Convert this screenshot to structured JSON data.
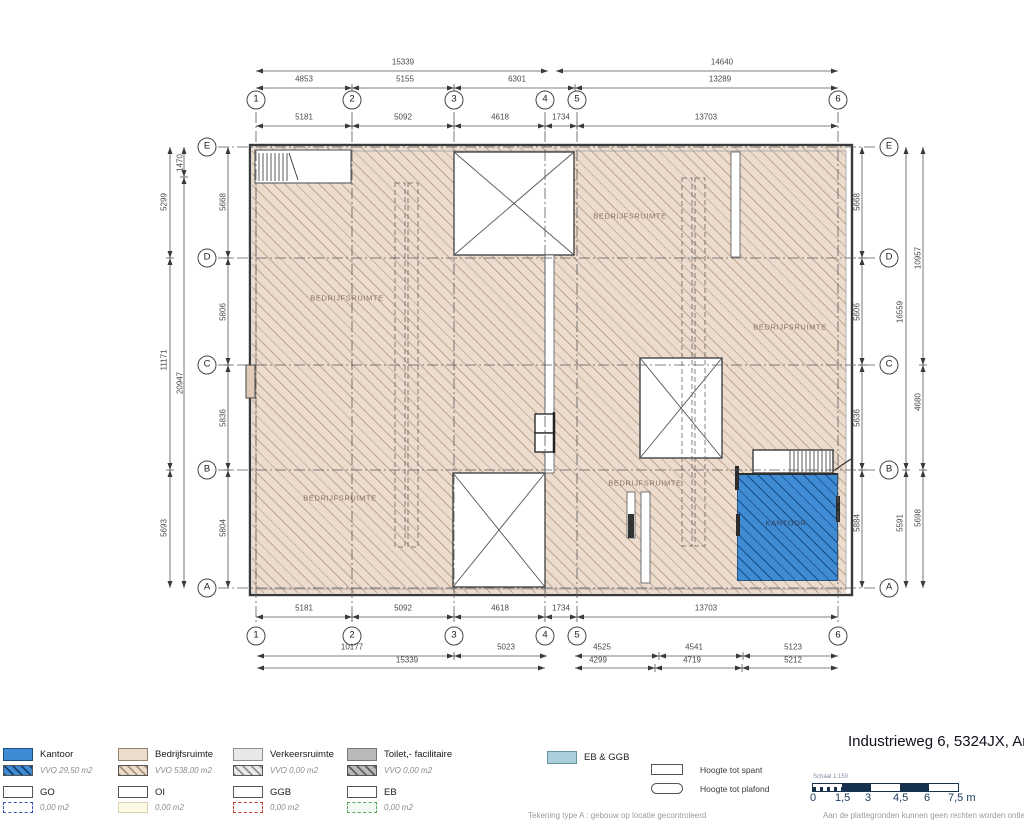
{
  "title": "Industrieweg 6, 5324JX, Am",
  "plan": {
    "room_labels": [
      {
        "text": "BEDRIJFSRUIMTE",
        "x": 347,
        "y": 298,
        "variant": "hall"
      },
      {
        "text": "BEDRIJFSRUIMTE",
        "x": 630,
        "y": 216,
        "variant": "hall"
      },
      {
        "text": "BEDRIJFSRUIMTE",
        "x": 790,
        "y": 327,
        "variant": "hall"
      },
      {
        "text": "BEDRIJFSRUIMTE",
        "x": 340,
        "y": 498,
        "variant": "hall"
      },
      {
        "text": "BEDRIJFSRUIMTE",
        "x": 645,
        "y": 483,
        "variant": "hall"
      },
      {
        "text": "KANTOOR",
        "x": 786,
        "y": 523,
        "variant": "office"
      }
    ],
    "grid_bubbles": [
      {
        "text": "1",
        "x": 256,
        "y": 100
      },
      {
        "text": "2",
        "x": 352,
        "y": 100
      },
      {
        "text": "3",
        "x": 454,
        "y": 100
      },
      {
        "text": "4",
        "x": 545,
        "y": 100
      },
      {
        "text": "5",
        "x": 577,
        "y": 100
      },
      {
        "text": "6",
        "x": 838,
        "y": 100
      },
      {
        "text": "1",
        "x": 256,
        "y": 636
      },
      {
        "text": "2",
        "x": 352,
        "y": 636
      },
      {
        "text": "3",
        "x": 454,
        "y": 636
      },
      {
        "text": "4",
        "x": 545,
        "y": 636
      },
      {
        "text": "5",
        "x": 577,
        "y": 636
      },
      {
        "text": "6",
        "x": 838,
        "y": 636
      },
      {
        "text": "E",
        "x": 207,
        "y": 147
      },
      {
        "text": "D",
        "x": 207,
        "y": 258
      },
      {
        "text": "C",
        "x": 207,
        "y": 365
      },
      {
        "text": "B",
        "x": 207,
        "y": 470
      },
      {
        "text": "A",
        "x": 207,
        "y": 588
      },
      {
        "text": "E",
        "x": 889,
        "y": 147
      },
      {
        "text": "D",
        "x": 889,
        "y": 258
      },
      {
        "text": "C",
        "x": 889,
        "y": 365
      },
      {
        "text": "B",
        "x": 889,
        "y": 470
      },
      {
        "text": "A",
        "x": 889,
        "y": 588
      }
    ],
    "dim_labels": [
      {
        "text": "15339",
        "x": 403,
        "y": 62
      },
      {
        "text": "14640",
        "x": 722,
        "y": 62
      },
      {
        "text": "4853",
        "x": 304,
        "y": 79
      },
      {
        "text": "5155",
        "x": 405,
        "y": 79
      },
      {
        "text": "6301",
        "x": 517,
        "y": 79
      },
      {
        "text": "13289",
        "x": 720,
        "y": 79
      },
      {
        "text": "5181",
        "x": 304,
        "y": 117
      },
      {
        "text": "5092",
        "x": 403,
        "y": 117
      },
      {
        "text": "4618",
        "x": 500,
        "y": 117
      },
      {
        "text": "1734",
        "x": 561,
        "y": 117
      },
      {
        "text": "13703",
        "x": 706,
        "y": 117
      },
      {
        "text": "5181",
        "x": 304,
        "y": 608
      },
      {
        "text": "5092",
        "x": 403,
        "y": 608
      },
      {
        "text": "4618",
        "x": 500,
        "y": 608
      },
      {
        "text": "1734",
        "x": 561,
        "y": 608
      },
      {
        "text": "13703",
        "x": 706,
        "y": 608
      },
      {
        "text": "10177",
        "x": 352,
        "y": 647
      },
      {
        "text": "5023",
        "x": 506,
        "y": 647
      },
      {
        "text": "4525",
        "x": 602,
        "y": 647
      },
      {
        "text": "4541",
        "x": 694,
        "y": 647
      },
      {
        "text": "5123",
        "x": 793,
        "y": 647
      },
      {
        "text": "15339",
        "x": 407,
        "y": 660
      },
      {
        "text": "4299",
        "x": 598,
        "y": 660
      },
      {
        "text": "4719",
        "x": 692,
        "y": 660
      },
      {
        "text": "5212",
        "x": 793,
        "y": 660
      },
      {
        "text": "5299",
        "x": 164,
        "y": 202,
        "rot": true
      },
      {
        "text": "11171",
        "x": 164,
        "y": 360,
        "rot": true
      },
      {
        "text": "5693",
        "x": 164,
        "y": 528,
        "rot": true
      },
      {
        "text": "1470",
        "x": 180,
        "y": 163,
        "rot": true
      },
      {
        "text": "20947",
        "x": 180,
        "y": 383,
        "rot": true
      },
      {
        "text": "5668",
        "x": 223,
        "y": 202,
        "rot": true
      },
      {
        "text": "5806",
        "x": 223,
        "y": 312,
        "rot": true
      },
      {
        "text": "5836",
        "x": 223,
        "y": 418,
        "rot": true
      },
      {
        "text": "5804",
        "x": 223,
        "y": 528,
        "rot": true
      },
      {
        "text": "5668",
        "x": 857,
        "y": 202,
        "rot": true
      },
      {
        "text": "5606",
        "x": 857,
        "y": 312,
        "rot": true
      },
      {
        "text": "5636",
        "x": 857,
        "y": 418,
        "rot": true
      },
      {
        "text": "5884",
        "x": 857,
        "y": 523,
        "rot": true
      },
      {
        "text": "16559",
        "x": 900,
        "y": 312,
        "rot": true
      },
      {
        "text": "5591",
        "x": 900,
        "y": 523,
        "rot": true
      },
      {
        "text": "10957",
        "x": 918,
        "y": 258,
        "rot": true
      },
      {
        "text": "4680",
        "x": 918,
        "y": 402,
        "rot": true
      },
      {
        "text": "5698",
        "x": 918,
        "y": 518,
        "rot": true
      }
    ]
  },
  "legend": {
    "areas": [
      {
        "label": "Kantoor",
        "area": "VVO 29,50 m2",
        "x": 3,
        "fill": "#3f8cd5",
        "stroke": "#1d4f7e",
        "hatch": "#13406f"
      },
      {
        "label": "Bedrijfsruimte",
        "area": "VVO 538,00 m2",
        "x": 118,
        "fill": "#ecdccd",
        "stroke": "#95836f",
        "hatch": "#a8937d"
      },
      {
        "label": "Verkeersruimte",
        "area": "VVO 0,00 m2",
        "x": 233,
        "fill": "#e8e8e8",
        "stroke": "#909090",
        "hatch": "#8f8f8f"
      },
      {
        "label": "Toilet,- facilitaire",
        "area": "VVO 0,00 m2",
        "x": 347,
        "fill": "#b9b9b9",
        "stroke": "#787878",
        "hatch": "#5f5f5f"
      }
    ],
    "extra": {
      "label": "EB & GGB",
      "fill": "#aacfdb",
      "stroke": "#68929f"
    },
    "zones": [
      {
        "label": "GO",
        "area": "0,00 m2",
        "x": 3,
        "sub_style": "dashed",
        "sub_color": "#3853b4",
        "sub_fill": "#ffffff"
      },
      {
        "label": "OI",
        "area": "0,00 m2",
        "x": 118,
        "sub_style": "solid",
        "sub_color": "#d8d3ae",
        "sub_fill": "#fcfae4"
      },
      {
        "label": "GGB",
        "area": "0,00 m2",
        "x": 233,
        "sub_style": "dashed",
        "sub_color": "#c23b2e",
        "sub_fill": "#ffffff"
      },
      {
        "label": "EB",
        "area": "0,00 m2",
        "x": 347,
        "sub_style": "dashed",
        "sub_color": "#5aa85e",
        "sub_fill": "#f2f9f2"
      }
    ],
    "heights": [
      {
        "label": "Hoogte tot spant",
        "shape": "rect"
      },
      {
        "label": "Hoogte tot plafond",
        "shape": "stadium"
      }
    ]
  },
  "scalebar": {
    "label": "Schaal 1:150",
    "unit_labels": [
      "0",
      "1,5",
      "3",
      "4,5",
      "6",
      "7,5 m"
    ],
    "bar_color": "#16324f"
  },
  "footer": {
    "left": "Tekening type A : gebouw op locatie gecontroleerd",
    "right": "Aan de plattegronden kunnen geen rechten worden ontleend"
  }
}
